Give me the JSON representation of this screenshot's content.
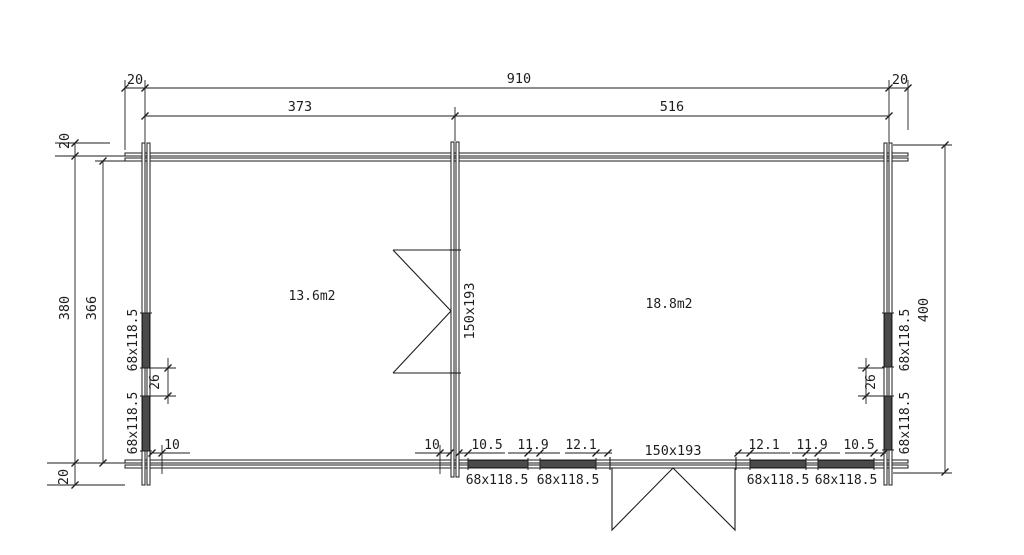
{
  "meta": {
    "drawing_type": "floor-plan",
    "units": "cm"
  },
  "colors": {
    "line": "#1d1d1d",
    "window_fill": "#4a4a4a",
    "background": "#ffffff"
  },
  "rooms": {
    "left_area": "13.6m2",
    "right_area": "18.8m2"
  },
  "dims": {
    "top": {
      "overhang_left": "20",
      "overall": "910",
      "left_room": "373",
      "right_room": "516",
      "overhang_right": "20"
    },
    "left": {
      "overhang_top": "20",
      "outer": "380",
      "inner": "366",
      "overhang_bottom": "20"
    },
    "right": {
      "overall": "400"
    },
    "left_wall": {
      "window_a": "68x118.5",
      "window_gap": "26",
      "window_b": "68x118.5"
    },
    "right_wall": {
      "window_a": "68x118.5",
      "window_gap": "26",
      "window_b": "68x118.5"
    },
    "bottom": {
      "corner_offset": "10",
      "partition_offset": "10",
      "gap_a": "10.5",
      "window_a": "68x118.5",
      "gap_b": "11.9",
      "window_b": "68x118.5",
      "gap_c": "12.1",
      "door": "150x193",
      "gap_d": "12.1",
      "window_c": "68x118.5",
      "gap_e": "11.9",
      "window_d": "68x118.5",
      "gap_f": "10.5"
    },
    "interior_door": "150x193"
  }
}
